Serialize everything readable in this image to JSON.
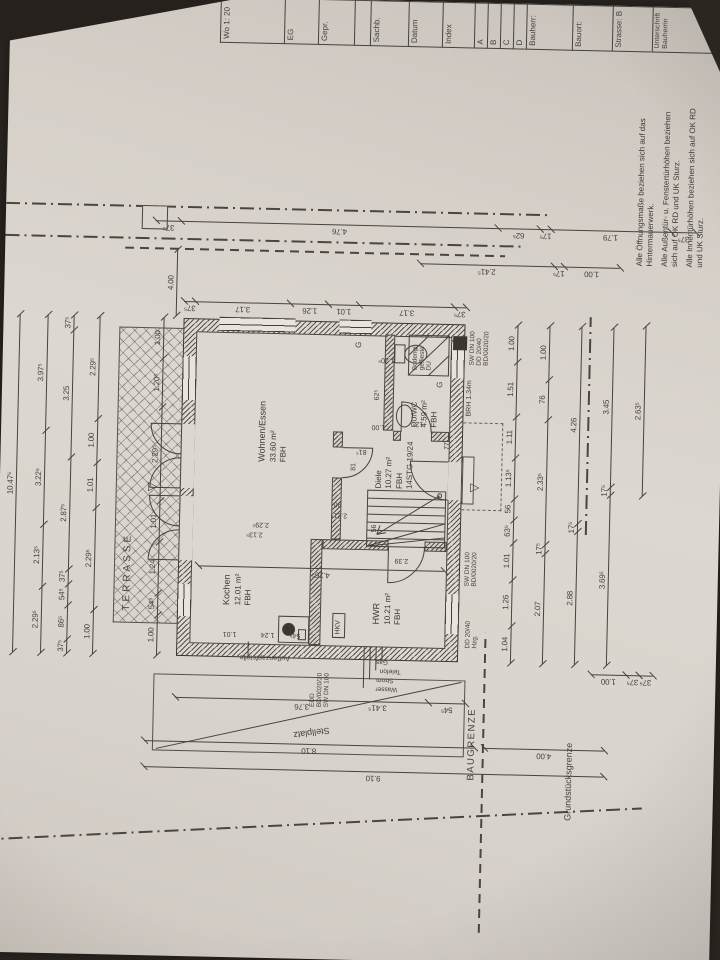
{
  "notes": [
    "Alle Öffnungsmaße beziehen sich auf das Hintermauerwerk.",
    "Alle Außentür- u. Fenstertürhöhen beziehen sich auf OK RD und UK Sturz.",
    "Alle Innentürhöhen beziehen sich auf OK RD und UK Sturz."
  ],
  "title_block": {
    "rows": [
      {
        "t": "Wo 1: 20",
        "h": 64
      },
      {
        "t": "EG",
        "h": 34
      },
      {
        "t": "Gepr.",
        "h": 36
      },
      {
        "t": "",
        "h": 16
      },
      {
        "t": "Sachb.",
        "h": 38
      },
      {
        "t": "Datum",
        "h": 34
      },
      {
        "t": "Index",
        "h": 32
      },
      {
        "t": "A",
        "h": 13
      },
      {
        "t": "B",
        "h": 13
      },
      {
        "t": "C",
        "h": 13
      },
      {
        "t": "D",
        "h": 13
      },
      {
        "t": "Bauherr:",
        "h": 46
      },
      {
        "t": "Bauort:",
        "h": 40
      },
      {
        "t": "Strasse: B",
        "h": 40
      },
      {
        "t": "Unterschrift Bauherrin",
        "h": 86
      }
    ]
  },
  "plan": {
    "terrace_label": "TERRASSE",
    "boundary": {
      "baugrenze": "BAUGRENZE",
      "grundstuecksgrenze": "Grundstücksgrenze",
      "stellplatz": "Stellplatz"
    },
    "rooms": [
      {
        "name": "Kochen",
        "area": "12.01 m²",
        "floor": "FBH"
      },
      {
        "name": "Wohnen/Essen",
        "area": "33.60 m²",
        "floor": "FBH"
      },
      {
        "name": "Diele",
        "area": "10.27 m²",
        "floor": "FBH",
        "extra": "14STG 19/24"
      },
      {
        "name": "HWR",
        "area": "10.21 m²",
        "floor": "FBH"
      },
      {
        "name": "DU/WC",
        "area": "4.59 m²",
        "floor": "FBH",
        "extra": "BRH 1.34m"
      }
    ],
    "chains": [
      {
        "d": "h",
        "x": 300,
        "y": 16,
        "len": 338,
        "s": [
          [
            "10.47⁵",
            1
          ]
        ]
      },
      {
        "d": "h",
        "x": 300,
        "y": 44,
        "len": 338,
        "s": [
          [
            "2.29⁵",
            2.295
          ],
          [
            "2.13⁵",
            2.135
          ],
          [
            "3.22⁵",
            3.225
          ],
          [
            "3.97⁵",
            3.975
          ]
        ]
      },
      {
        "d": "h",
        "x": 300,
        "y": 70,
        "len": 338,
        "s": [
          [
            "37⁵",
            0.375
          ],
          [
            "86⁵",
            0.865
          ],
          [
            "54⁵",
            0.545
          ],
          [
            "37⁵",
            0.375
          ],
          [
            "2.87⁵",
            2.875
          ],
          [
            "3.25",
            3.25
          ],
          [
            "37⁵",
            0.375
          ]
        ]
      },
      {
        "d": "h",
        "x": 300,
        "y": 96,
        "len": 338,
        "s": [
          [
            "1.00",
            1
          ],
          [
            "2.29⁵",
            2.295
          ],
          [
            "1.01",
            1.01
          ],
          [
            "1.00",
            1
          ],
          [
            "2.29⁵",
            2.295
          ]
        ]
      },
      {
        "d": "h",
        "x": 300,
        "y": 160,
        "len": 338,
        "s": [
          [
            "1.00",
            1
          ],
          [
            "54⁵",
            0.545
          ],
          [
            "1.24",
            1.24
          ],
          [
            "1.01",
            1.01
          ],
          [
            "2.29⁵",
            2.295
          ],
          [
            "1.20⁵",
            1.205
          ],
          [
            "1.00",
            1
          ]
        ]
      },
      {
        "d": "v",
        "x": 654,
        "y": 180,
        "len": 282,
        "s": [
          [
            "37⁵",
            0.375
          ],
          [
            "3.17",
            3.17
          ],
          [
            "1.26",
            1.26
          ],
          [
            "1.01",
            1.01
          ],
          [
            "3.17",
            3.17
          ],
          [
            "37⁵",
            0.375
          ]
        ]
      },
      {
        "d": "v",
        "x": 697,
        "y": 415,
        "len": 200,
        "s": [
          [
            "2.41⁵",
            2.415
          ],
          [
            "17⁵",
            0.175
          ],
          [
            "1.00",
            1
          ]
        ]
      },
      {
        "d": "v",
        "x": 734,
        "y": 150,
        "len": 540,
        "s": [
          [
            "37⁵",
            0.375
          ],
          [
            "4.76",
            4.76
          ],
          [
            "62⁵",
            0.625
          ],
          [
            "17⁵",
            0.175
          ],
          [
            "1.79",
            1.79
          ],
          [
            "37⁵",
            0.375
          ]
        ]
      },
      {
        "d": "h",
        "x": 640,
        "y": 172,
        "len": 66,
        "s": [
          [
            "4.00",
            1
          ]
        ]
      },
      {
        "d": "h",
        "x": 300,
        "y": 514,
        "len": 338,
        "s": [
          [
            "1.04",
            1.04
          ],
          [
            "1.26",
            1.26
          ],
          [
            "1.01",
            1.01
          ],
          [
            "63⁵",
            0.635
          ],
          [
            "56",
            0.56
          ],
          [
            "1.13⁵",
            1.135
          ],
          [
            "1.11",
            1.11
          ],
          [
            "1.51",
            1.51
          ],
          [
            "1.00",
            1
          ]
        ]
      },
      {
        "d": "h",
        "x": 300,
        "y": 546,
        "len": 338,
        "s": [
          [
            "2.07",
            2.07
          ],
          [
            "17⁵",
            0.175
          ],
          [
            "2.33⁵",
            2.335
          ],
          [
            "76",
            0.76
          ],
          [
            "1.00",
            1
          ]
        ]
      },
      {
        "d": "h",
        "x": 300,
        "y": 578,
        "len": 338,
        "s": [
          [
            "2.88",
            2.88
          ],
          [
            "17⁵",
            0.175
          ],
          [
            "4.26",
            4.26
          ]
        ]
      },
      {
        "d": "h",
        "x": 300,
        "y": 610,
        "len": 338,
        "s": [
          [
            "3.69⁵",
            3.695
          ],
          [
            "17⁵",
            0.175
          ],
          [
            "3.45",
            3.45
          ]
        ]
      },
      {
        "d": "h",
        "x": 470,
        "y": 642,
        "len": 170,
        "s": [
          [
            "2.63⁵",
            1
          ]
        ]
      },
      {
        "d": "v",
        "x": 258,
        "y": 180,
        "len": 290,
        "s": [
          [
            "3.76",
            3.76
          ],
          [
            "54⁵",
            0.545
          ]
        ]
      },
      {
        "d": "v",
        "x": 214,
        "y": 150,
        "len": 330,
        "s": [
          [
            "8.10",
            1
          ]
        ]
      },
      {
        "d": "v",
        "x": 188,
        "y": 150,
        "len": 460,
        "s": [
          [
            "9.10",
            1
          ]
        ]
      },
      {
        "d": "v",
        "x": 214,
        "y": 490,
        "len": 120,
        "s": [
          [
            "4.00",
            1
          ]
        ]
      },
      {
        "d": "v",
        "x": 290,
        "y": 595,
        "len": 62,
        "s": [
          [
            "1.00",
            1
          ],
          [
            "37⁵",
            0.37
          ],
          [
            "37⁵",
            0.37
          ]
        ]
      },
      {
        "d": "v",
        "x": 390,
        "y": 200,
        "len": 246,
        "s": [
          [
            "4.26⁵",
            1
          ]
        ]
      }
    ],
    "floats": [
      {
        "t": "BRH 1.34m",
        "x": 546,
        "y": 464,
        "fs": 7
      },
      {
        "t": "Bodengl.",
        "x": 591,
        "y": 409,
        "fs": 6.5
      },
      {
        "t": "geflieste",
        "x": 591,
        "y": 416,
        "fs": 6.5
      },
      {
        "t": "DU",
        "x": 591,
        "y": 423,
        "fs": 6.5
      },
      {
        "t": "G",
        "x": 612,
        "y": 352,
        "fs": 8,
        "n": "window-mark-g"
      },
      {
        "t": "G",
        "x": 574,
        "y": 434,
        "fs": 8,
        "n": "window-mark-g"
      },
      {
        "t": "HKV",
        "x": 325,
        "y": 338,
        "fs": 7,
        "n": "hkv-label"
      },
      {
        "t": "EDD",
        "x": 252,
        "y": 314,
        "fs": 6.5,
        "n": "pipe-label"
      },
      {
        "t": "BD/0020/20",
        "x": 252,
        "y": 321,
        "fs": 6.5,
        "n": "pipe-label"
      },
      {
        "t": "SW DN 100",
        "x": 252,
        "y": 328,
        "fs": 6.5,
        "n": "pipe-label"
      },
      {
        "t": "Außenzapfstelle",
        "x": 297,
        "y": 294,
        "r": -90,
        "fs": 7,
        "n": "outdoor-tap-label"
      },
      {
        "t": "Wasser",
        "x": 268,
        "y": 402,
        "r": -90,
        "fs": 6.5,
        "n": "utility-label"
      },
      {
        "t": "Strom",
        "x": 277,
        "y": 398,
        "r": -90,
        "fs": 6.5,
        "n": "utility-label"
      },
      {
        "t": "Telefon",
        "x": 286,
        "y": 405,
        "r": -90,
        "fs": 6.5,
        "n": "utility-label"
      },
      {
        "t": "Gas",
        "x": 295,
        "y": 392,
        "r": -90,
        "fs": 6.5,
        "n": "utility-label"
      },
      {
        "t": "SW DN 100",
        "x": 376,
        "y": 466,
        "fs": 6.5,
        "n": "pipe-label"
      },
      {
        "t": "BD/0020/20",
        "x": 376,
        "y": 473,
        "fs": 6.5,
        "n": "pipe-label"
      },
      {
        "t": "DD 20/40",
        "x": 314,
        "y": 468,
        "fs": 6.5,
        "n": "pipe-label"
      },
      {
        "t": "Hzg.",
        "x": 314,
        "y": 475,
        "fs": 6.5,
        "n": "pipe-label"
      },
      {
        "t": "SW DN 100",
        "x": 597,
        "y": 466,
        "fs": 6.5,
        "n": "pipe-label"
      },
      {
        "t": "DD 20/40",
        "x": 597,
        "y": 473,
        "fs": 6.5,
        "n": "pipe-label"
      },
      {
        "t": "BD/0020/20",
        "x": 597,
        "y": 480,
        "fs": 6.5,
        "n": "pipe-label"
      },
      {
        "t": "Stellplatz",
        "x": 224,
        "y": 336,
        "r": -99,
        "fs": 9,
        "n": "stellplatz-label"
      },
      {
        "t": "3.41⁵",
        "x": 249,
        "y": 392,
        "r": -90,
        "fs": 8
      },
      {
        "t": "2.39",
        "x": 397,
        "y": 410,
        "r": -90,
        "fs": 7
      },
      {
        "t": "90",
        "x": 452,
        "y": 342,
        "r": -90,
        "fs": 7
      },
      {
        "t": "2.21⁵",
        "x": 441,
        "y": 348,
        "r": -90,
        "fs": 7
      },
      {
        "t": "81",
        "x": 489,
        "y": 350,
        "fs": 7
      },
      {
        "t": "1.00",
        "x": 530,
        "y": 384,
        "r": -90,
        "fs": 7
      },
      {
        "t": "1.20⁵",
        "x": 597,
        "y": 392,
        "r": -90,
        "fs": 7
      },
      {
        "t": "2.13⁵",
        "x": 420,
        "y": 264,
        "r": -90,
        "fs": 7
      },
      {
        "t": "2.29⁵",
        "x": 430,
        "y": 270,
        "r": -90,
        "fs": 7
      },
      {
        "t": "1.01",
        "x": 320,
        "y": 240,
        "r": -90,
        "fs": 7
      },
      {
        "t": "1.24",
        "x": 320,
        "y": 278,
        "r": -90,
        "fs": 7
      },
      {
        "t": "54⁵",
        "x": 320,
        "y": 304,
        "r": -90,
        "fs": 7
      },
      {
        "t": "12⁵",
        "x": 534,
        "y": 422,
        "r": -90,
        "fs": 7
      },
      {
        "t": "77",
        "x": 512,
        "y": 443,
        "fs": 7
      },
      {
        "t": "81⁵",
        "x": 505,
        "y": 366,
        "r": -90,
        "fs": 7
      },
      {
        "t": "62⁵",
        "x": 560,
        "y": 372,
        "fs": 7
      },
      {
        "t": "56",
        "x": 428,
        "y": 372,
        "fs": 7
      },
      {
        "t": "▽",
        "x": 464,
        "y": 146,
        "fs": 12,
        "n": "terrace-entrance-arrow"
      },
      {
        "t": "▽",
        "x": 470,
        "y": 468,
        "fs": 12,
        "n": "entrance-arrow"
      }
    ]
  }
}
